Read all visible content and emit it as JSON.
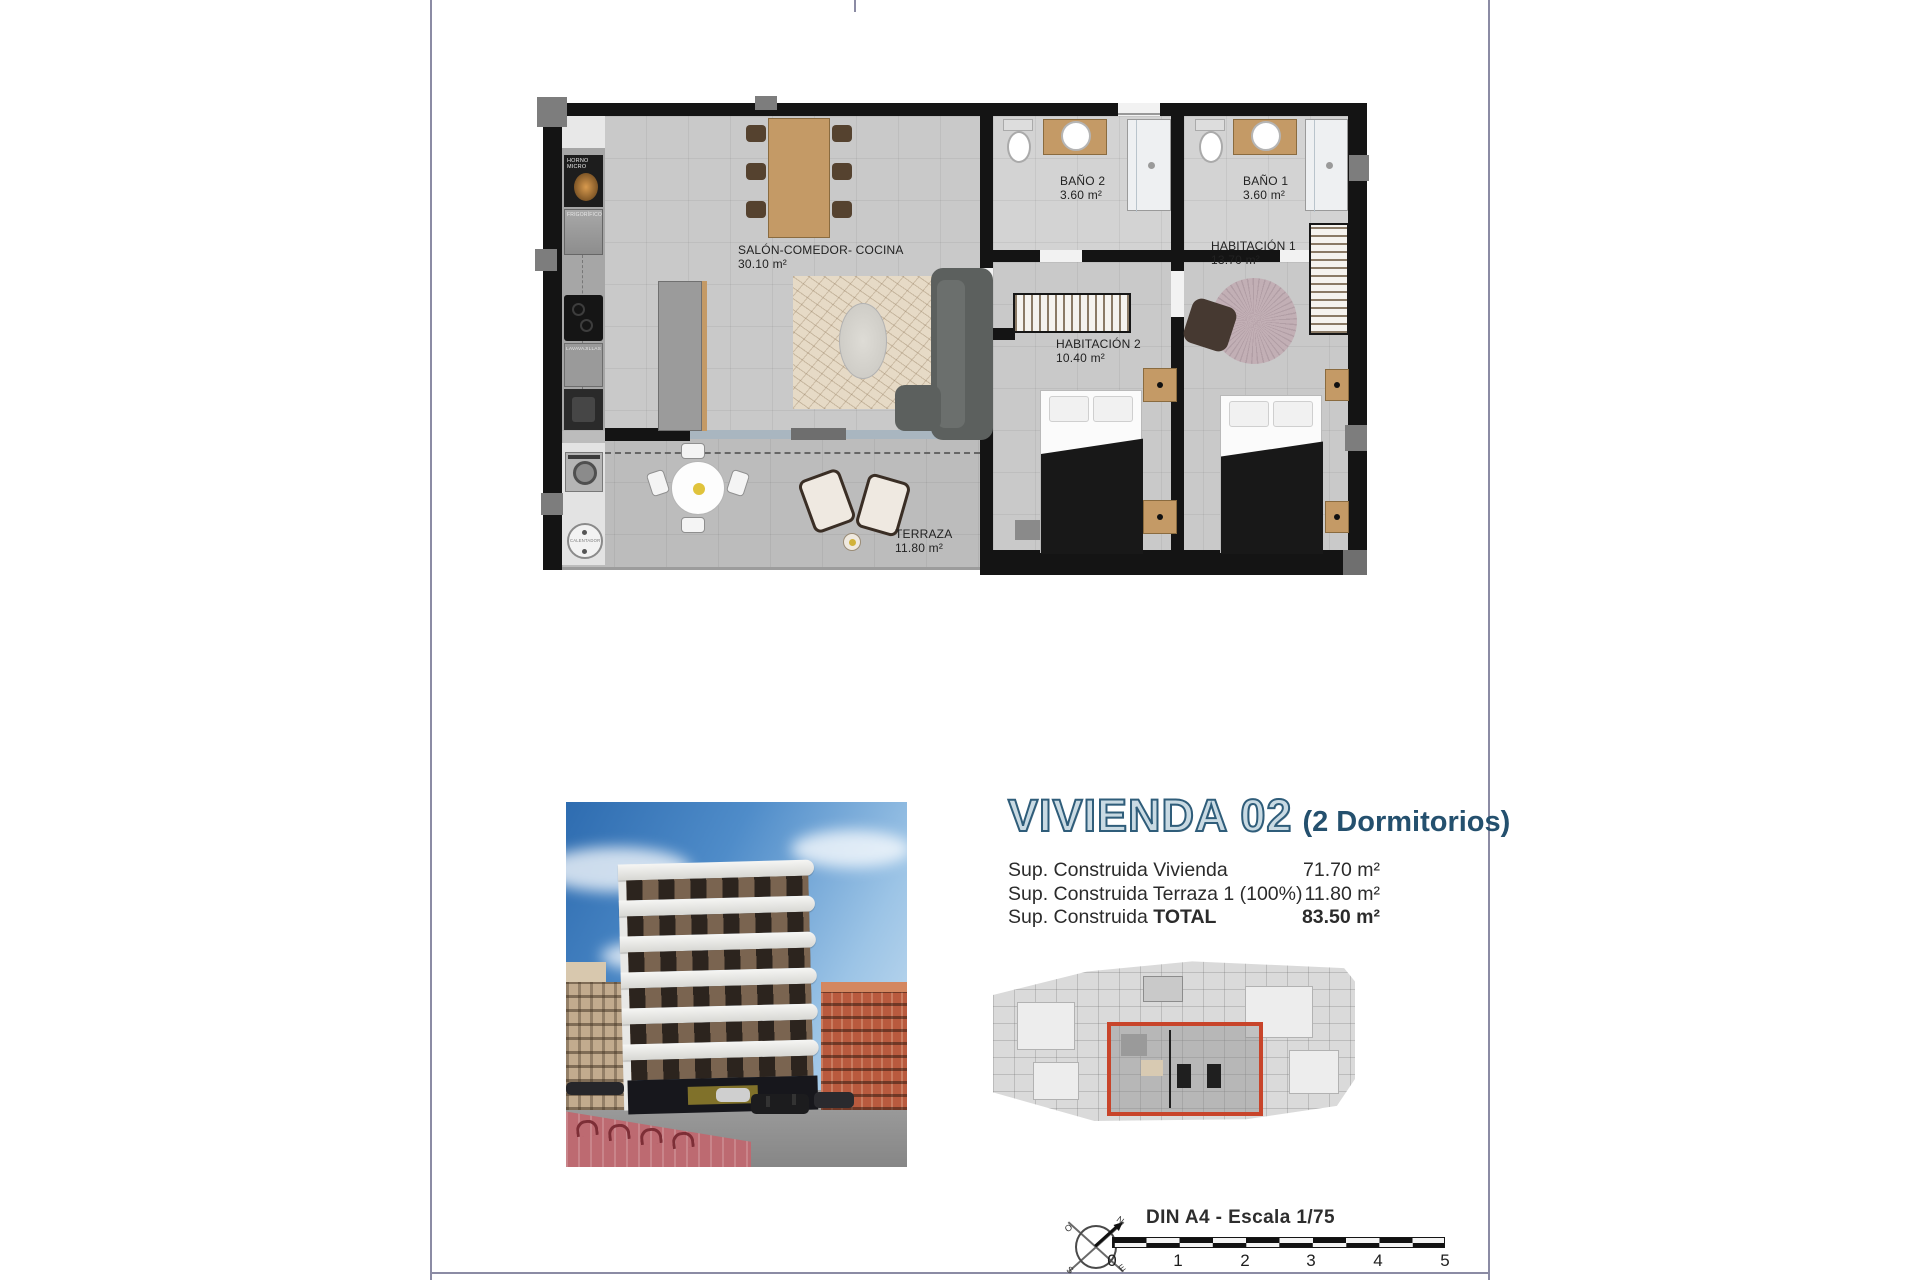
{
  "colors": {
    "page_line": "#8b8ba4",
    "wall": "#141414",
    "title_fill": "#c9dae3",
    "title_stroke": "#2f5d7a",
    "subtitle": "#24506e",
    "highlight": "#c8442a"
  },
  "floor_plan": {
    "rooms": [
      {
        "id": "salon",
        "name": "SALÓN-COMEDOR- COCINA",
        "area": "30.10 m²"
      },
      {
        "id": "bano2",
        "name": "BAÑO 2",
        "area": "3.60 m²"
      },
      {
        "id": "bano1",
        "name": "BAÑO 1",
        "area": "3.60 m²"
      },
      {
        "id": "habitacion1",
        "name": "HABITACIÓN 1",
        "area": "13.70 m²"
      },
      {
        "id": "habitacion2",
        "name": "HABITACIÓN 2",
        "area": "10.40 m²"
      },
      {
        "id": "terraza",
        "name": "TERRAZA",
        "area": "11.80 m²"
      }
    ],
    "appliances": [
      {
        "id": "horno",
        "label": "HORNO MICRO"
      },
      {
        "id": "frigorifico",
        "label": "FRIGORÍFICO"
      },
      {
        "id": "lavavajillas",
        "label": "LAVAVAJILLAS"
      },
      {
        "id": "calentador",
        "label": "CALENTADOR"
      }
    ]
  },
  "info": {
    "title": "VIVIENDA 02",
    "subtitle": "(2 Dormitorios)",
    "rows": [
      {
        "label": "Sup. Construida Vivienda",
        "value": "71.70 m²"
      },
      {
        "label": "Sup. Construida Terraza 1 (100%)",
        "value": "11.80 m²"
      },
      {
        "label_prefix": "Sup. Construida ",
        "label_bold": "TOTAL",
        "value": "83.50 m²"
      }
    ]
  },
  "footer": {
    "scale_label": "DIN A4 - Escala 1/75",
    "scale_ticks": [
      "0",
      "1",
      "2",
      "3",
      "4",
      "5"
    ],
    "compass": {
      "n": "N",
      "o": "O",
      "s": "S",
      "e": "E"
    }
  }
}
